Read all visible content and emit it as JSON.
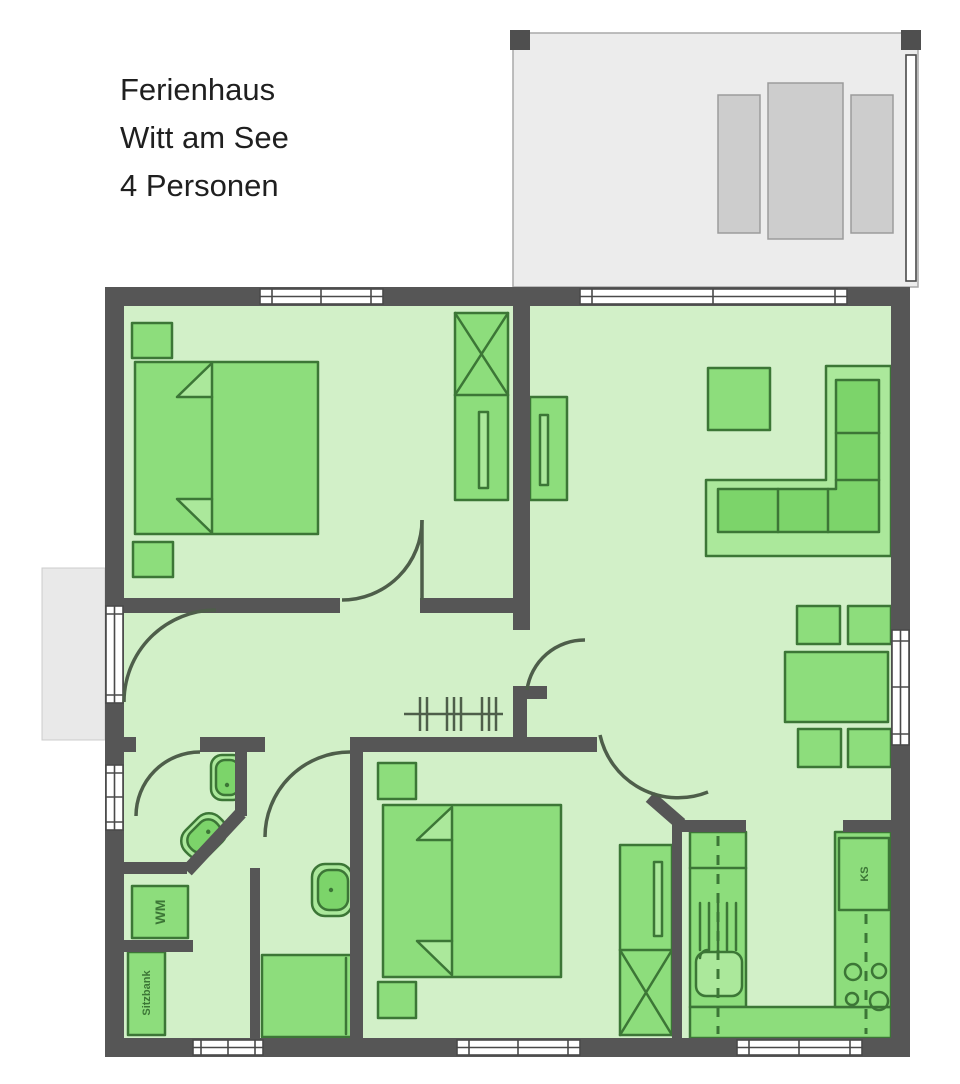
{
  "title": {
    "line1": "Ferienhaus",
    "line2": "Witt am See",
    "line3": "4 Personen"
  },
  "labels": {
    "washing_machine": "WM",
    "fridge": "KS",
    "bench": "Sitzbank"
  },
  "colors": {
    "wall": "#565656",
    "floor": "#d2f0c8",
    "furniture": "#8ddd7c",
    "furniture_light": "#abe89b",
    "furniture_dark": "#7cd46a",
    "outline": "#3c7636",
    "arc": "#4e5e4a",
    "terrace": "#ececec",
    "terrace_border": "#a9a9a9",
    "terrace_furniture": "#cdcdcd",
    "terrace_furniture_border": "#9b9b9b",
    "porch": "#e9e9e9",
    "window_frame": "#4a4a4a",
    "text": "#1f1f1f",
    "label": "#3c7636"
  }
}
